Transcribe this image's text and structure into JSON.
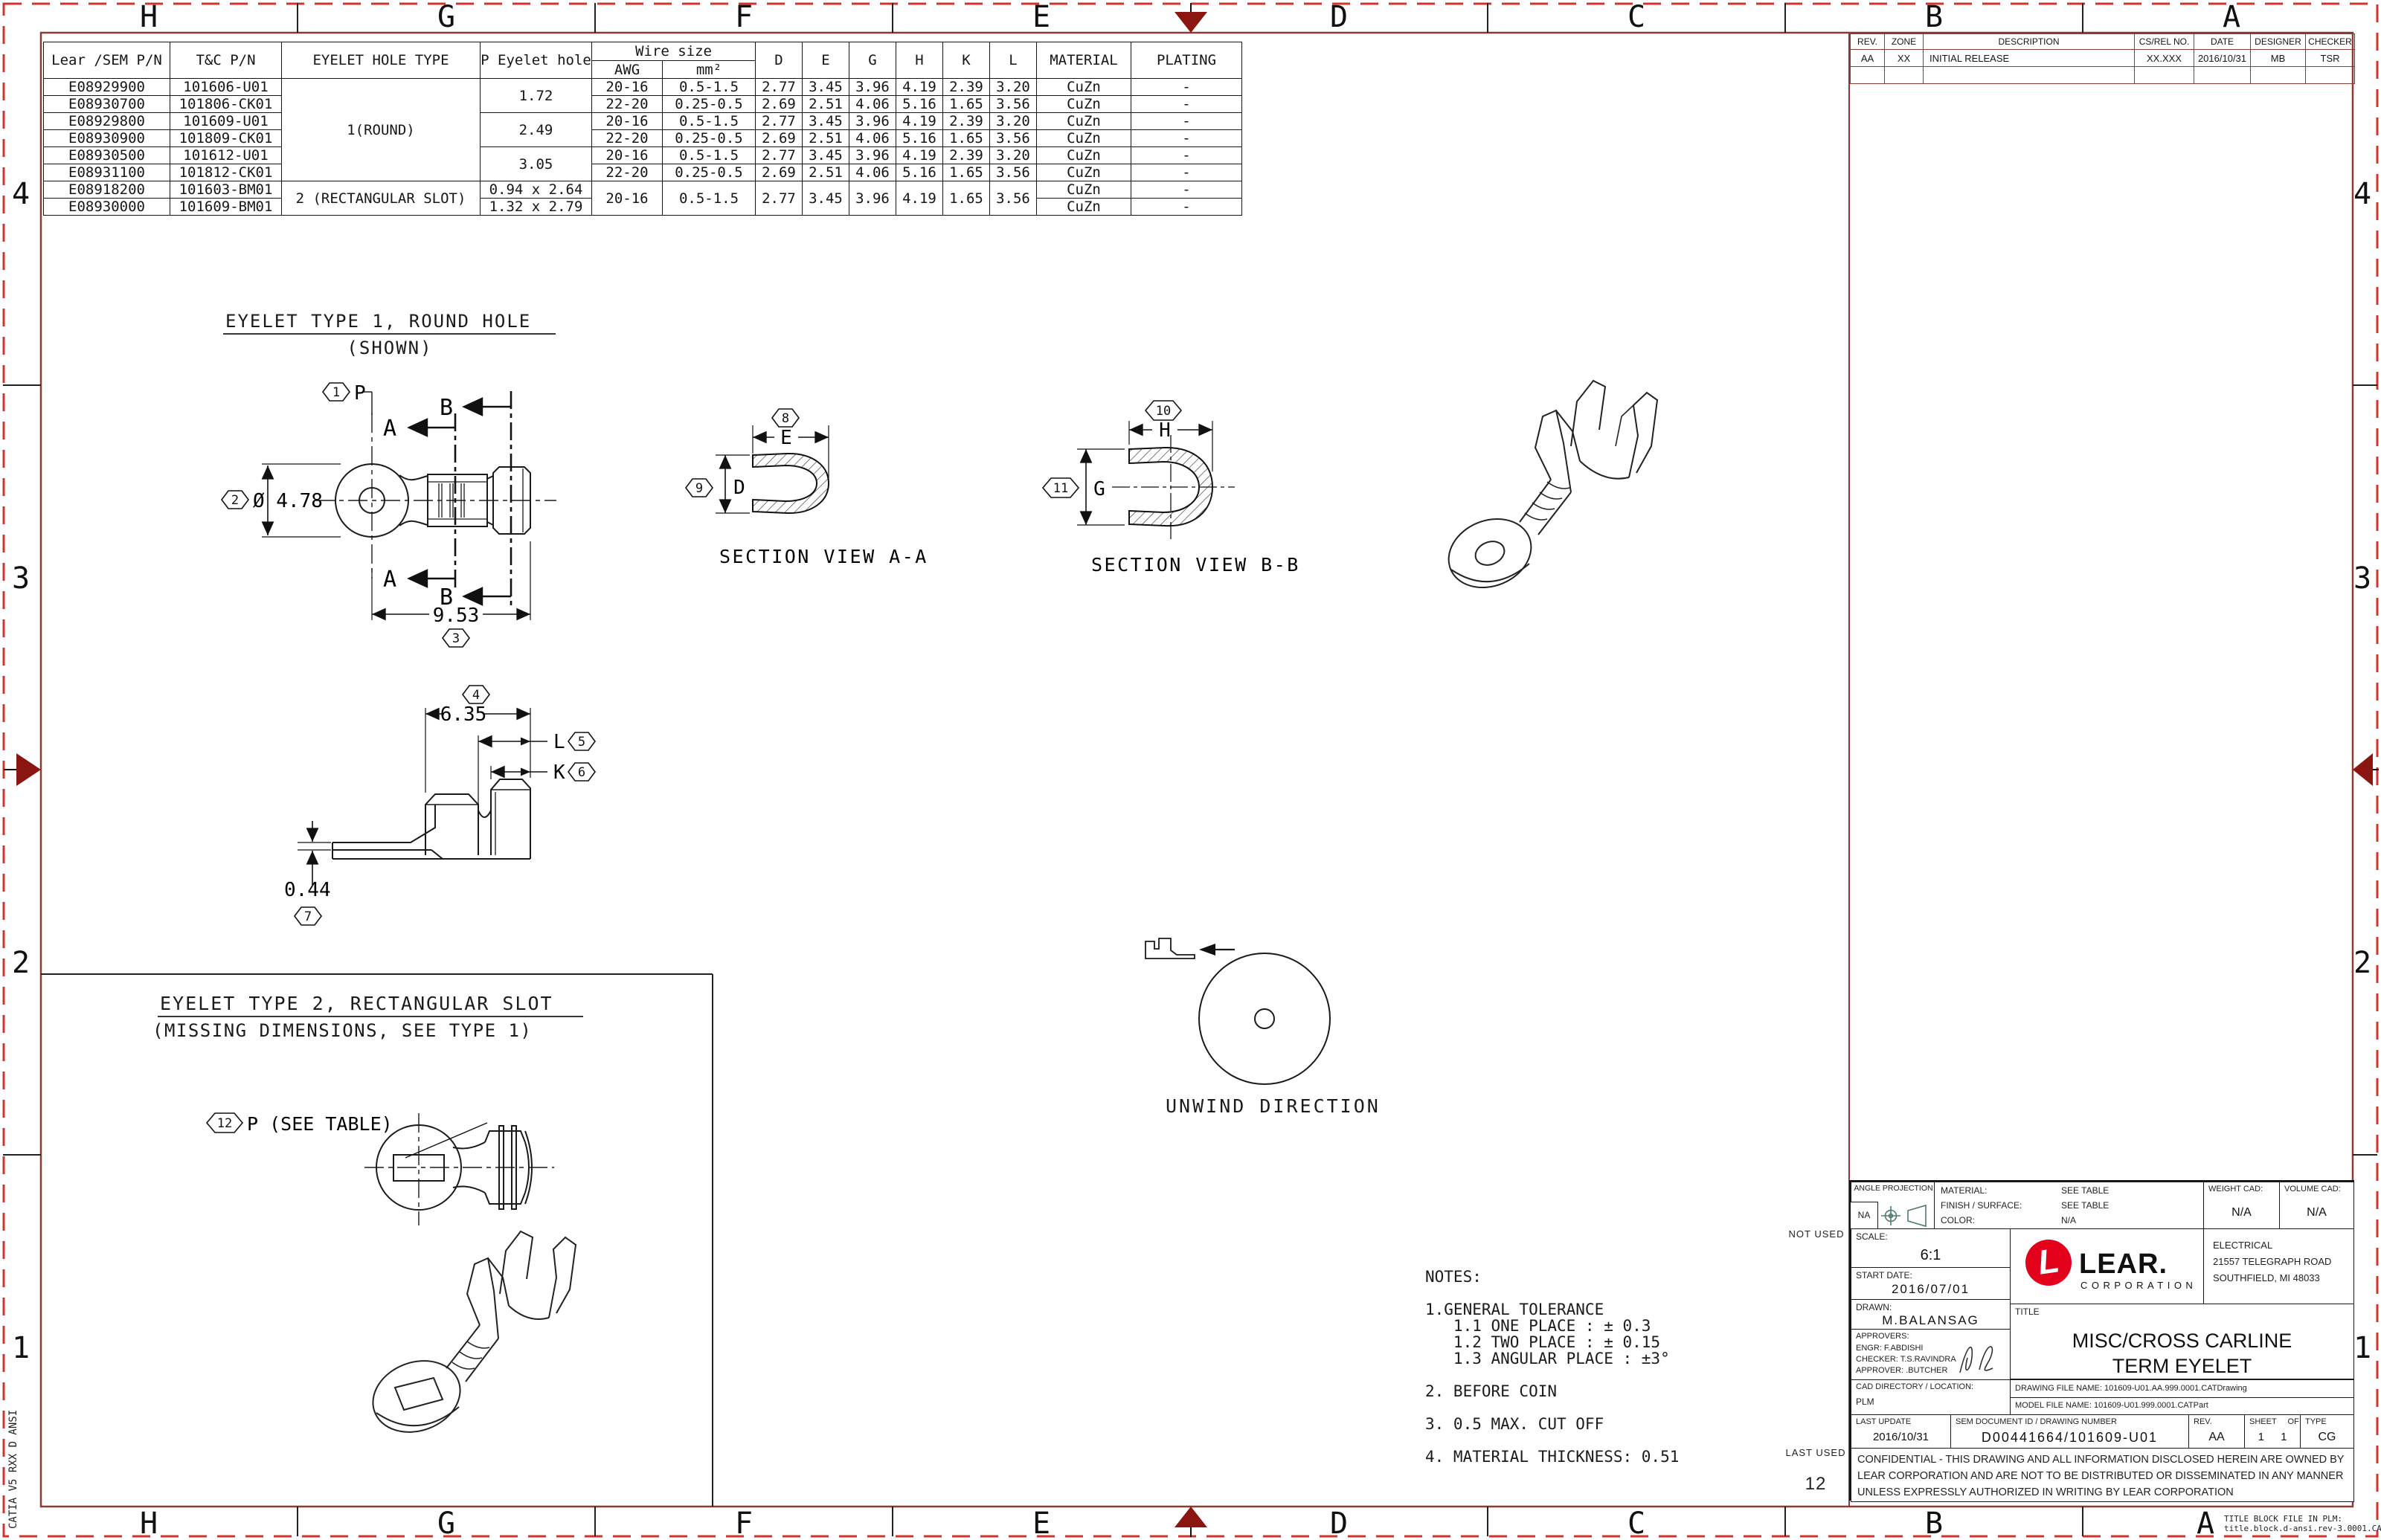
{
  "colors": {
    "frame": "#8a3c34",
    "dashed_border": "#d0342c",
    "nav_arrow": "#8b1510",
    "lear_red": "#e2001a",
    "projection_icon": "#4e7d6b",
    "line_art": "#1a1a1a"
  },
  "border": {
    "cols": [
      "H",
      "G",
      "F",
      "E",
      "D",
      "C",
      "B",
      "A"
    ],
    "rows": [
      "4",
      "3",
      "2",
      "1"
    ],
    "catia": "CATIA V5 RXX D ANSI",
    "plm_note1": "TITLE BLOCK FILE IN PLM:",
    "plm_note2": "title.block.d-ansi.rev-3.0001.CATDrawing"
  },
  "parts_table": {
    "headers": {
      "lear": "Lear /SEM P/N",
      "tc": "T&C P/N",
      "hole_type": "EYELET HOLE TYPE",
      "p_hole": "P Eyelet\nhole",
      "wire_size": "Wire size",
      "awg": "AWG",
      "mm2": "mm²",
      "d": "D",
      "e": "E",
      "g": "G",
      "h": "H",
      "k": "K",
      "l": "L",
      "material": "MATERIAL",
      "plating": "PLATING"
    },
    "hole_type_1": "1(ROUND)",
    "hole_type_2": "2 (RECTANGULAR SLOT)",
    "p_holes": [
      "1.72",
      "2.49",
      "3.05",
      "0.94 x 2.64",
      "1.32 x 2.79"
    ],
    "rows": [
      {
        "lear": "E08929900",
        "tc": "101606-U01",
        "awg": "20-16",
        "mm2": "0.5-1.5",
        "d": "2.77",
        "e": "3.45",
        "g": "3.96",
        "h": "4.19",
        "k": "2.39",
        "l": "3.20",
        "material": "CuZn",
        "plating": "-"
      },
      {
        "lear": "E08930700",
        "tc": "101806-CK01",
        "awg": "22-20",
        "mm2": "0.25-0.5",
        "d": "2.69",
        "e": "2.51",
        "g": "4.06",
        "h": "5.16",
        "k": "1.65",
        "l": "3.56",
        "material": "CuZn",
        "plating": "-"
      },
      {
        "lear": "E08929800",
        "tc": "101609-U01",
        "awg": "20-16",
        "mm2": "0.5-1.5",
        "d": "2.77",
        "e": "3.45",
        "g": "3.96",
        "h": "4.19",
        "k": "2.39",
        "l": "3.20",
        "material": "CuZn",
        "plating": "-"
      },
      {
        "lear": "E08930900",
        "tc": "101809-CK01",
        "awg": "22-20",
        "mm2": "0.25-0.5",
        "d": "2.69",
        "e": "2.51",
        "g": "4.06",
        "h": "5.16",
        "k": "1.65",
        "l": "3.56",
        "material": "CuZn",
        "plating": "-"
      },
      {
        "lear": "E08930500",
        "tc": "101612-U01",
        "awg": "20-16",
        "mm2": "0.5-1.5",
        "d": "2.77",
        "e": "3.45",
        "g": "3.96",
        "h": "4.19",
        "k": "2.39",
        "l": "3.20",
        "material": "CuZn",
        "plating": "-"
      },
      {
        "lear": "E08931100",
        "tc": "101812-CK01",
        "awg": "22-20",
        "mm2": "0.25-0.5",
        "d": "2.69",
        "e": "2.51",
        "g": "4.06",
        "h": "5.16",
        "k": "1.65",
        "l": "3.56",
        "material": "CuZn",
        "plating": "-"
      },
      {
        "lear": "E08918200",
        "tc": "101603-BM01",
        "awg": "20-16",
        "mm2": "0.5-1.5",
        "d": "2.77",
        "e": "3.45",
        "g": "3.96",
        "h": "4.19",
        "k": "1.65",
        "l": "3.56",
        "material": "CuZn",
        "plating": "-"
      },
      {
        "lear": "E08930000",
        "tc": "101609-BM01",
        "material": "CuZn",
        "plating": "-"
      }
    ]
  },
  "revision_table": {
    "headers": [
      "REV.",
      "ZONE",
      "DESCRIPTION",
      "CS/REL NO.",
      "DATE",
      "DESIGNER",
      "CHECKER"
    ],
    "row": {
      "rev": "AA",
      "zone": "XX",
      "description": "INITIAL RELEASE",
      "cs_rel": "XX.XXX",
      "date": "2016/10/31",
      "designer": "MB",
      "checker": "TSR"
    }
  },
  "views": {
    "type1_title": "EYELET TYPE 1, ROUND HOLE",
    "type1_sub": "(SHOWN)",
    "type2_title": "EYELET TYPE 2, RECTANGULAR SLOT",
    "type2_sub": "(MISSING DIMENSIONS, SEE TYPE 1)",
    "section_a": "SECTION VIEW A-A",
    "section_b": "SECTION VIEW B-B",
    "unwind": "UNWIND DIRECTION"
  },
  "dims": {
    "p": "P",
    "dia": "Ø 4.78",
    "len953": "9.53",
    "len635": "6.35",
    "l": "L",
    "k": "K",
    "t044": "0.44",
    "e": "E",
    "d": "D",
    "h": "H",
    "g": "G",
    "p_table": "P (SEE TABLE)",
    "a": "A",
    "b": "B"
  },
  "balloons": [
    "1",
    "2",
    "3",
    "4",
    "5",
    "6",
    "7",
    "8",
    "9",
    "10",
    "11",
    "12"
  ],
  "notes": {
    "text": "NOTES:\n\n1.GENERAL TOLERANCE\n   1.1 ONE PLACE : ± 0.3\n   1.2 TWO PLACE : ± 0.15\n   1.3 ANGULAR PLACE : ±3°\n\n2. BEFORE COIN\n\n3. 0.5 MAX. CUT OFF\n\n4. MATERIAL THICKNESS: 0.51"
  },
  "title_block": {
    "not_used": "NOT USED",
    "last_used": "LAST USED",
    "last_used_num": "12",
    "angle_label": "ANGLE\nPROJECTION",
    "angle_na": "NA",
    "material_label": "MATERIAL:",
    "material_value": "SEE TABLE",
    "finish_label": "FINISH / SURFACE:",
    "finish_value": "SEE TABLE",
    "color_label": "COLOR:",
    "color_value": "N/A",
    "weight_label": "WEIGHT CAD:",
    "weight_value": "N/A",
    "volume_label": "VOLUME CAD:",
    "volume_value": "N/A",
    "scale_label": "SCALE:",
    "scale_value": "6:1",
    "start_date_label": "START DATE:",
    "start_date_value": "2016/07/01",
    "drawn_label": "DRAWN:",
    "drawn_value": "M.BALANSAG",
    "approvers_label": "APPROVERS:",
    "engr": "ENGR: F.ABDISHI",
    "checker": "CHECKER: T.S.RAVINDRA",
    "approver": "APPROVER: .BUTCHER",
    "brand_l": "L",
    "brand": "LEAR.",
    "brand_sub": "CORPORATION",
    "dept": "ELECTRICAL",
    "address1": "21557 TELEGRAPH ROAD",
    "address2": "SOUTHFIELD, MI  48033",
    "title_label": "TITLE",
    "title_line1": "MISC/CROSS CARLINE",
    "title_line2": "TERM EYELET",
    "cad_dir_label": "CAD DIRECTORY / LOCATION:",
    "cad_dir_value": "PLM",
    "drawing_file": "DRAWING FILE NAME: 101609-U01.AA.999.0001.CATDrawing",
    "model_file": "MODEL FILE NAME: 101609-U01.999.0001.CATPart",
    "last_update_label": "LAST UPDATE",
    "last_update_value": "2016/10/31",
    "sem_label": "SEM DOCUMENT ID / DRAWING NUMBER",
    "sem_value": "D00441664/101609-U01",
    "rev_label": "REV.",
    "rev_value": "AA",
    "sheet_label": "SHEET",
    "of_label": "OF",
    "sheet_value": "1",
    "of_value": "1",
    "type_label": "TYPE",
    "type_value": "CG",
    "confidential": "CONFIDENTIAL - THIS DRAWING AND ALL INFORMATION DISCLOSED HEREIN ARE OWNED BY LEAR CORPORATION AND ARE NOT TO BE DISTRIBUTED OR DISSEMINATED IN ANY MANNER UNLESS EXPRESSLY AUTHORIZED IN WRITING BY LEAR CORPORATION"
  }
}
